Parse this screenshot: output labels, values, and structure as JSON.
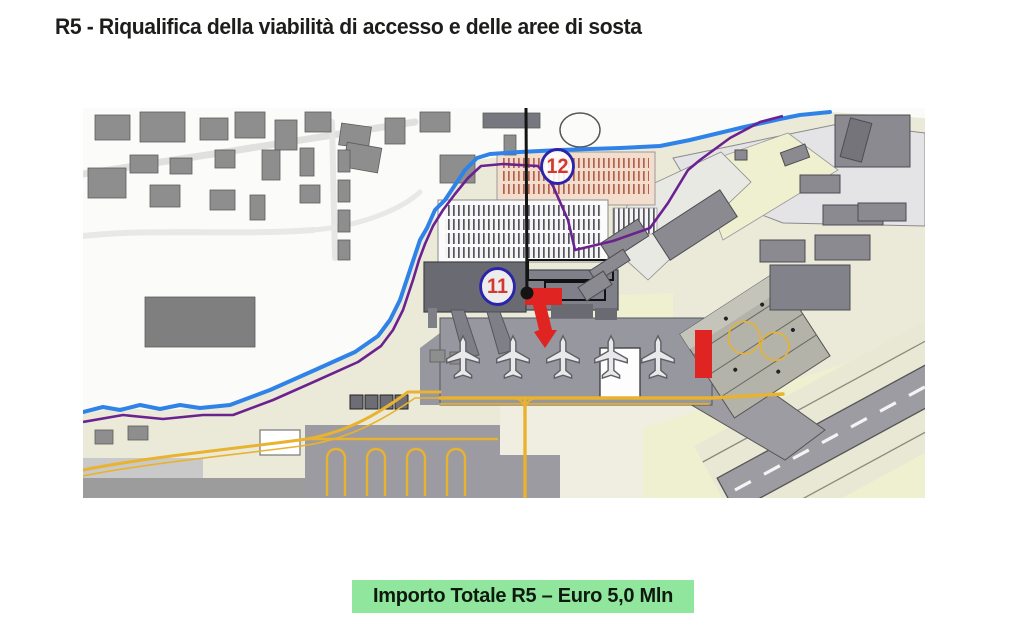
{
  "page": {
    "title": "R5 - Riqualifica della viabilità di accesso e delle aree di sosta",
    "banner": "Importo Totale R5 – Euro 5,0 Mln"
  },
  "map": {
    "markers": [
      {
        "id": "marker-11",
        "label": "11"
      },
      {
        "id": "marker-12",
        "label": "12"
      }
    ]
  },
  "theme": {
    "title-color": "#1d1d1b",
    "banner-bg": "#90e69c",
    "banner-color": "#0e1a10",
    "marker-border": "#2b24aa",
    "marker-number": "#d23732",
    "highlight-red": "#e02421",
    "canal-blue": "#2f82e8",
    "boundary-purple": "#6b2290",
    "taxiline-yellow": "#e9b22f",
    "leader-black": "#141414"
  }
}
